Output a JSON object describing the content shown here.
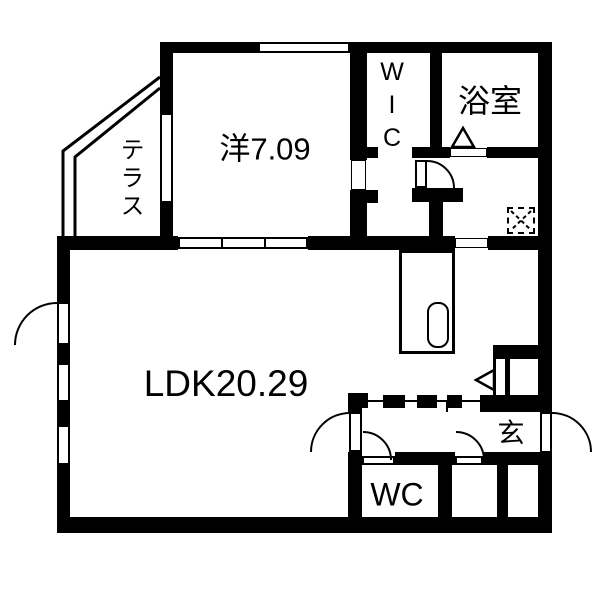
{
  "title": "apartment-floor-plan",
  "colors": {
    "wall": "#000000",
    "background": "#ffffff",
    "line": "#000000"
  },
  "rooms": {
    "western_room": {
      "label": "洋7.09"
    },
    "ldk": {
      "label": "LDK20.29"
    },
    "bathroom": {
      "label": "浴室"
    },
    "toilet": {
      "label": "WC"
    },
    "entrance": {
      "label": "玄"
    },
    "terrace": {
      "label": "テラス"
    },
    "walk_in_closet": {
      "label": "WIC"
    }
  }
}
